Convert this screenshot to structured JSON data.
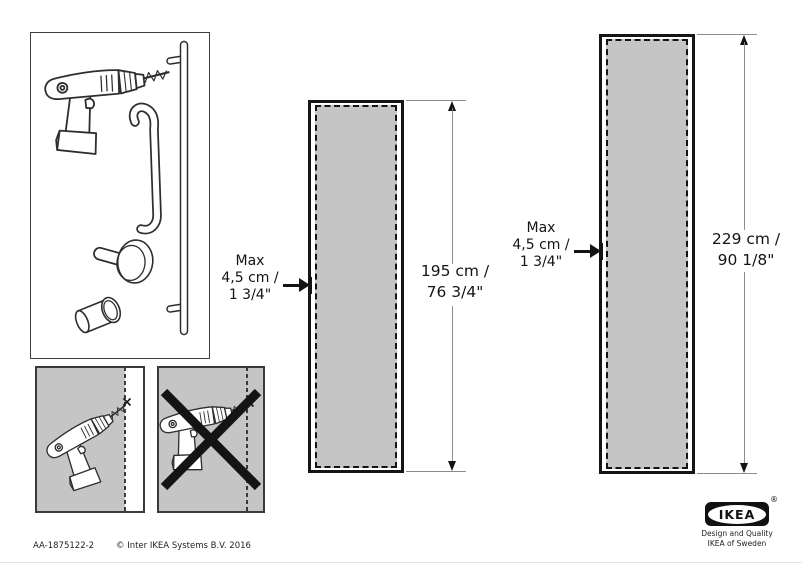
{
  "document": {
    "footer": {
      "doc_id": "AA-1875122-2",
      "copyright": "© Inter IKEA Systems B.V. 2016"
    },
    "logo": {
      "brand": "IKEA",
      "registered": "®",
      "tagline1": "Design and Quality",
      "tagline2": "IKEA of Sweden"
    }
  },
  "diagram": {
    "colors": {
      "panel_gray": "#c5c5c5",
      "line_black": "#141414",
      "dimension_gray": "#8c8c8c"
    },
    "parts_box": {
      "items": [
        "cordless-drill",
        "door-handle",
        "bar-handle",
        "round-knob",
        "cylinder-knob"
      ]
    },
    "instruction_panels": [
      {
        "icon": "drill-angled-into-edge",
        "status": "allowed"
      },
      {
        "icon": "drill-straight-into-edge",
        "status": "prohibited",
        "overlay": "prohibition-cross"
      }
    ],
    "doors": [
      {
        "max_label": {
          "line1": "Max",
          "line2": "4,5 cm /",
          "line3": "1 3/4\""
        },
        "height_label": {
          "line1": "195 cm /",
          "line2": "76 3/4\""
        }
      },
      {
        "max_label": {
          "line1": "Max",
          "line2": "4,5 cm /",
          "line3": "1 3/4\""
        },
        "height_label": {
          "line1": "229 cm /",
          "line2": "90 1/8\""
        }
      }
    ]
  }
}
